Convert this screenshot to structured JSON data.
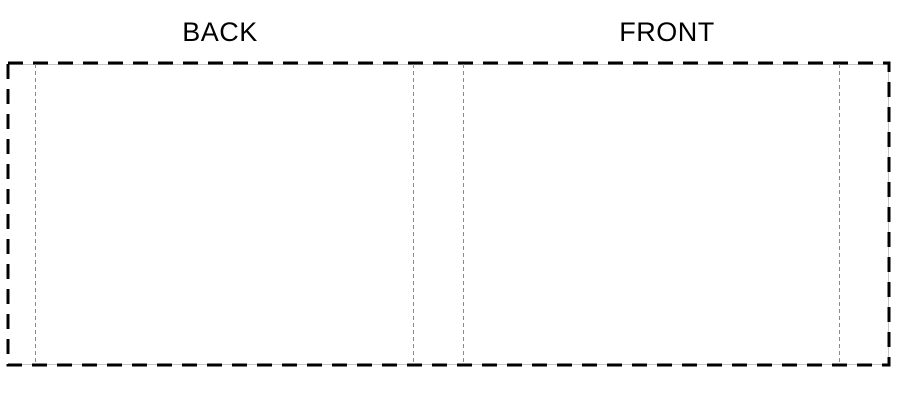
{
  "template": {
    "back_label": "BACK",
    "front_label": "FRONT"
  },
  "colors": {
    "background": "#ffffff",
    "label_text": "#000000",
    "trim_dash": "#000000",
    "base_line": "#c6c6c6",
    "fold_line": "#8a8a8a"
  }
}
